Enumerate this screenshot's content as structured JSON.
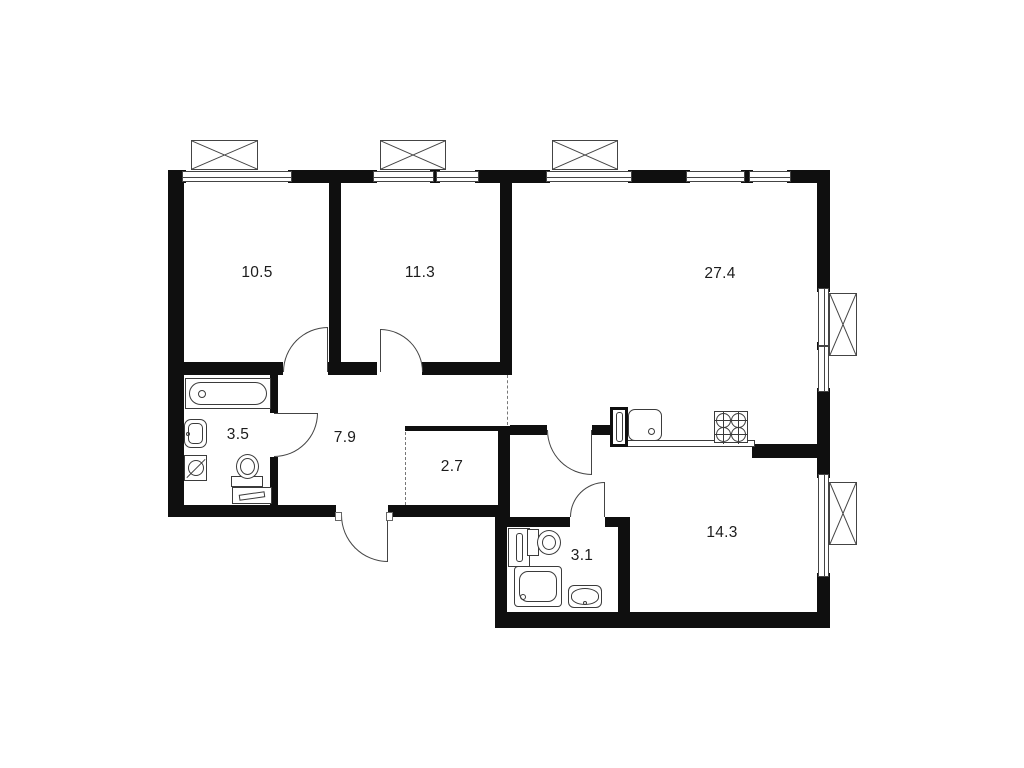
{
  "canvas": {
    "width": 1024,
    "height": 768,
    "background": "#ffffff"
  },
  "colors": {
    "wall": "#0f0f0f",
    "fixture_line": "#3b3b3b",
    "window_line": "#444444",
    "label": "#1c1c1c",
    "dashed": "#777777"
  },
  "rooms": [
    {
      "label": "10.5",
      "cx": 257,
      "cy": 273
    },
    {
      "label": "11.3",
      "cx": 420,
      "cy": 273
    },
    {
      "label": "27.4",
      "cx": 720,
      "cy": 274
    },
    {
      "label": "3.5",
      "cx": 238,
      "cy": 435
    },
    {
      "label": "7.9",
      "cx": 345,
      "cy": 438
    },
    {
      "label": "2.7",
      "cx": 452,
      "cy": 467
    },
    {
      "label": "3.1",
      "cx": 582,
      "cy": 556
    },
    {
      "label": "14.3",
      "cx": 722,
      "cy": 533
    }
  ],
  "plan": {
    "walls": [
      [
        168,
        170,
        662,
        13
      ],
      [
        168,
        170,
        16,
        347
      ],
      [
        168,
        505,
        168,
        12
      ],
      [
        388,
        505,
        119,
        12
      ],
      [
        495,
        505,
        12,
        123
      ],
      [
        495,
        612,
        335,
        16
      ],
      [
        817,
        170,
        13,
        458
      ],
      [
        329,
        183,
        12,
        189
      ],
      [
        500,
        183,
        12,
        192
      ],
      [
        184,
        362,
        99,
        13
      ],
      [
        328,
        362,
        49,
        13
      ],
      [
        422,
        362,
        90,
        13
      ],
      [
        270,
        375,
        8,
        38
      ],
      [
        270,
        457,
        8,
        48
      ],
      [
        498,
        426,
        12,
        91
      ],
      [
        510,
        425,
        37,
        10
      ],
      [
        592,
        425,
        18,
        10
      ],
      [
        752,
        444,
        78,
        14
      ],
      [
        507,
        517,
        63,
        10
      ],
      [
        605,
        517,
        25,
        10
      ],
      [
        618,
        517,
        12,
        97
      ]
    ],
    "thin_walls": [
      [
        405,
        426,
        93,
        5
      ]
    ],
    "windows_top": [
      {
        "x": 186,
        "w": 102
      },
      {
        "x": 377,
        "w": 53
      },
      {
        "x": 440,
        "w": 35
      },
      {
        "x": 550,
        "w": 78
      },
      {
        "x": 690,
        "w": 51
      },
      {
        "x": 753,
        "w": 34
      }
    ],
    "windows_right": [
      {
        "y": 292,
        "h": 50
      },
      {
        "y": 350,
        "h": 38
      },
      {
        "y": 478,
        "h": 95
      }
    ],
    "balcony_boxes": [
      [
        191,
        140,
        67,
        30
      ],
      [
        380,
        140,
        66,
        30
      ],
      [
        552,
        140,
        66,
        30
      ],
      [
        829,
        293,
        28,
        63
      ],
      [
        829,
        482,
        28,
        63
      ]
    ],
    "doors": [
      {
        "x": 283,
        "y": 327,
        "w": 45,
        "h": 45,
        "corner": "tl",
        "leaf": "right"
      },
      {
        "x": 380,
        "y": 329,
        "w": 43,
        "h": 43,
        "corner": "tr",
        "leaf": "left"
      },
      {
        "x": 274,
        "y": 413,
        "w": 44,
        "h": 44,
        "corner": "br",
        "leaf": "top"
      },
      {
        "x": 341,
        "y": 515,
        "w": 47,
        "h": 47,
        "corner": "bl",
        "leaf": "right"
      },
      {
        "x": 547,
        "y": 430,
        "w": 45,
        "h": 45,
        "corner": "bl",
        "leaf": "right"
      },
      {
        "x": 570,
        "y": 482,
        "w": 35,
        "h": 35,
        "corner": "tl",
        "leaf": "right"
      }
    ],
    "jamb_ticks": [
      [
        335,
        512,
        7,
        9
      ],
      [
        386,
        512,
        7,
        9
      ]
    ],
    "dashed_lines": [
      {
        "x": 507,
        "y": 375,
        "h": 50
      },
      {
        "x": 405,
        "y": 432,
        "h": 73
      }
    ],
    "fixtures": [
      {
        "type": "counter",
        "x": 610,
        "y": 440,
        "w": 145,
        "h": 7
      },
      {
        "type": "bathtub",
        "x": 185,
        "y": 378,
        "w": 86,
        "h": 31
      },
      {
        "type": "wall-sink",
        "x": 184,
        "y": 419,
        "w": 23,
        "h": 29
      },
      {
        "type": "washing-machine",
        "x": 184,
        "y": 455,
        "w": 23,
        "h": 26
      },
      {
        "type": "toilet-south",
        "x": 231,
        "y": 454,
        "w": 32,
        "h": 33
      },
      {
        "type": "cabinet",
        "x": 232,
        "y": 487,
        "w": 40,
        "h": 17
      },
      {
        "type": "towel-rail",
        "x": 508,
        "y": 528,
        "w": 22,
        "h": 39
      },
      {
        "type": "toilet-east",
        "x": 527,
        "y": 529,
        "w": 35,
        "h": 27
      },
      {
        "type": "shower",
        "x": 514,
        "y": 566,
        "w": 48,
        "h": 41
      },
      {
        "type": "basin",
        "x": 568,
        "y": 585,
        "w": 34,
        "h": 23
      },
      {
        "type": "vent-shaft",
        "x": 610,
        "y": 407,
        "w": 18,
        "h": 40
      },
      {
        "type": "kitchen-sink",
        "x": 628,
        "y": 409,
        "w": 34,
        "h": 32
      },
      {
        "type": "stove",
        "x": 714,
        "y": 411,
        "w": 34,
        "h": 32
      }
    ]
  }
}
